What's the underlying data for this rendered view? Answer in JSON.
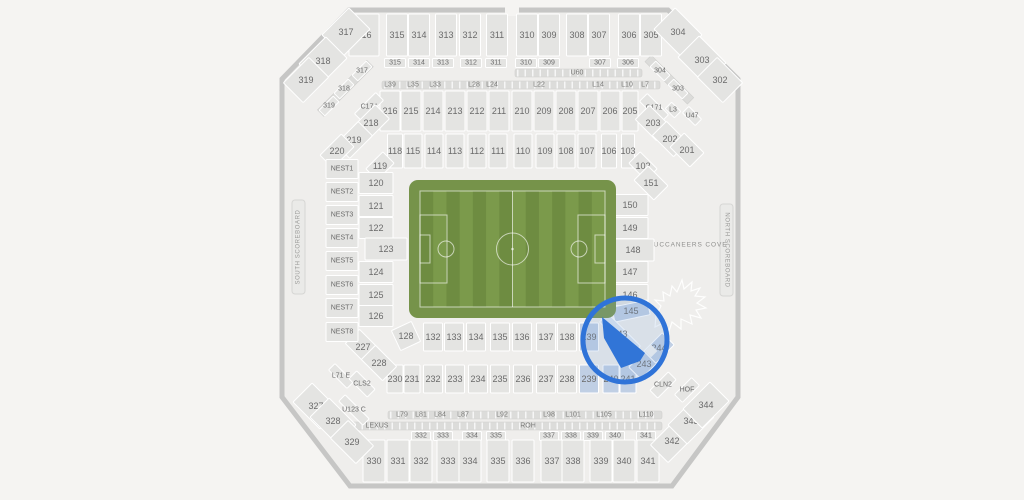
{
  "map": {
    "venue_note": "stadium seating chart with soccer field",
    "colors": {
      "page_bg": "#f5f4f2",
      "wall": "#c6c6c5",
      "concourse": "#efeeec",
      "section_fill": "#e4e4e2",
      "label_color": "#6a6a6a",
      "highlight_fill": "#c0cfe4",
      "highlight_strip_fill": "#dbe5f2",
      "selected_fill": "#1d68d6",
      "circle_stroke": "#2f73d8",
      "field_apron": "#76934a",
      "field_dark": "#6e8c41",
      "field_light": "#7b9a4b"
    },
    "labels_static": {
      "south_scoreboard": "SOUTH SCOREBOARD",
      "north_scoreboard": "NORTH SCOREBOARD",
      "cove": "BUCCANEERS COVE"
    },
    "section_groups": [
      {
        "name": "upper-300-top",
        "y": 35,
        "h": 42,
        "w": 21,
        "items": [
          {
            "t": "316",
            "x": 364,
            "w": 30
          },
          {
            "t": "315",
            "x": 397
          },
          {
            "t": "314",
            "x": 419
          },
          {
            "t": "313",
            "x": 446
          },
          {
            "t": "312",
            "x": 470
          },
          {
            "t": "311",
            "x": 497
          },
          {
            "t": "310",
            "x": 527
          },
          {
            "t": "309",
            "x": 549
          },
          {
            "t": "308",
            "x": 577
          },
          {
            "t": "307",
            "x": 599
          },
          {
            "t": "306",
            "x": 629
          },
          {
            "t": "305",
            "x": 651
          }
        ]
      },
      {
        "name": "upper-300-corners",
        "w": 38,
        "h": 30,
        "items": [
          {
            "t": "317",
            "x": 346,
            "y": 32,
            "r": -45
          },
          {
            "t": "318",
            "x": 323,
            "y": 61,
            "r": -45
          },
          {
            "t": "319",
            "x": 306,
            "y": 80,
            "r": -45,
            "w": 36,
            "h": 28
          },
          {
            "t": "304",
            "x": 678,
            "y": 32,
            "r": 45
          },
          {
            "t": "303",
            "x": 702,
            "y": 60,
            "r": 45
          },
          {
            "t": "302",
            "x": 720,
            "y": 80,
            "r": 45,
            "w": 36,
            "h": 28
          }
        ]
      },
      {
        "name": "suite-row-300",
        "y": 63,
        "h": 9,
        "w": 21,
        "f": 7,
        "items": [
          {
            "t": "315",
            "x": 395
          },
          {
            "t": "314",
            "x": 419
          },
          {
            "t": "313",
            "x": 443
          },
          {
            "t": "312",
            "x": 471
          },
          {
            "t": "311",
            "x": 496
          },
          {
            "t": "310",
            "x": 526
          },
          {
            "t": "309",
            "x": 549
          },
          {
            "t": "307",
            "x": 600
          },
          {
            "t": "306",
            "x": 628
          }
        ]
      },
      {
        "name": "suite-diag",
        "w": 20,
        "h": 8,
        "f": 7,
        "items": [
          {
            "t": "317",
            "x": 362,
            "y": 71,
            "r": -45
          },
          {
            "t": "318",
            "x": 344,
            "y": 89,
            "r": -45
          },
          {
            "t": "319",
            "x": 329,
            "y": 106,
            "r": -45
          },
          {
            "t": "304",
            "x": 660,
            "y": 71,
            "r": 45
          },
          {
            "t": "303",
            "x": 678,
            "y": 89,
            "r": 45
          }
        ]
      },
      {
        "name": "upper-200-top",
        "y": 111,
        "h": 40,
        "w": 20,
        "items": [
          {
            "t": "216",
            "x": 390
          },
          {
            "t": "215",
            "x": 411
          },
          {
            "t": "214",
            "x": 433
          },
          {
            "t": "213",
            "x": 455
          },
          {
            "t": "212",
            "x": 477
          },
          {
            "t": "211",
            "x": 499
          },
          {
            "t": "210",
            "x": 522
          },
          {
            "t": "209",
            "x": 544
          },
          {
            "t": "208",
            "x": 566
          },
          {
            "t": "207",
            "x": 588
          },
          {
            "t": "206",
            "x": 610
          },
          {
            "t": "205",
            "x": 630,
            "w": 16
          }
        ]
      },
      {
        "name": "corner-200-left",
        "items": [
          {
            "t": "C174",
            "x": 369,
            "y": 107,
            "r": -45,
            "w": 30,
            "h": 11,
            "f": 7
          },
          {
            "t": "218",
            "x": 371,
            "y": 123,
            "r": -45,
            "w": 32,
            "h": 20
          },
          {
            "t": "219",
            "x": 354,
            "y": 140,
            "r": -45,
            "w": 32,
            "h": 20
          },
          {
            "t": "220",
            "x": 337,
            "y": 151,
            "r": -45,
            "w": 30,
            "h": 18
          }
        ]
      },
      {
        "name": "corner-200-right",
        "items": [
          {
            "t": "C171",
            "x": 654,
            "y": 108,
            "r": 45,
            "w": 30,
            "h": 11,
            "f": 7
          },
          {
            "t": "L3",
            "x": 673,
            "y": 110,
            "r": 45,
            "w": 13,
            "h": 9,
            "f": 7
          },
          {
            "t": "U47",
            "x": 692,
            "y": 116,
            "r": 45,
            "w": 18,
            "h": 9,
            "f": 7
          },
          {
            "t": "203",
            "x": 653,
            "y": 123,
            "r": 45,
            "w": 30,
            "h": 20
          },
          {
            "t": "202",
            "x": 670,
            "y": 139,
            "r": 45,
            "w": 30,
            "h": 20
          },
          {
            "t": "201",
            "x": 687,
            "y": 150,
            "r": 45,
            "w": 28,
            "h": 20
          }
        ]
      },
      {
        "name": "upper-100-top",
        "y": 151,
        "h": 34,
        "w": 18,
        "items": [
          {
            "t": "118",
            "x": 395,
            "w": 15
          },
          {
            "t": "115",
            "x": 413
          },
          {
            "t": "114",
            "x": 434
          },
          {
            "t": "113",
            "x": 455
          },
          {
            "t": "112",
            "x": 477
          },
          {
            "t": "111",
            "x": 498
          },
          {
            "t": "110",
            "x": 523
          },
          {
            "t": "109",
            "x": 545
          },
          {
            "t": "108",
            "x": 566
          },
          {
            "t": "107",
            "x": 587
          },
          {
            "t": "106",
            "x": 609,
            "w": 15
          },
          {
            "t": "103",
            "x": 628,
            "w": 13
          }
        ]
      },
      {
        "name": "corner-100",
        "items": [
          {
            "t": "119",
            "x": 380,
            "y": 166,
            "r": -45,
            "w": 24,
            "h": 16
          },
          {
            "t": "102",
            "x": 643,
            "y": 166,
            "r": 45,
            "w": 24,
            "h": 16
          },
          {
            "t": "151",
            "x": 651,
            "y": 183,
            "r": 45,
            "w": 28,
            "h": 20
          }
        ]
      },
      {
        "name": "left-col-100",
        "x": 376,
        "w": 34,
        "h": 21,
        "items": [
          {
            "t": "120",
            "y": 183
          },
          {
            "t": "121",
            "y": 206
          },
          {
            "t": "122",
            "y": 228
          },
          {
            "t": "123",
            "x": 386,
            "y": 249,
            "w": 42,
            "h": 22
          },
          {
            "t": "124",
            "y": 272
          },
          {
            "t": "125",
            "y": 295
          },
          {
            "t": "126",
            "y": 316
          }
        ]
      },
      {
        "name": "right-col-100",
        "x": 630,
        "w": 36,
        "h": 21,
        "items": [
          {
            "t": "150",
            "y": 205
          },
          {
            "t": "149",
            "y": 228
          },
          {
            "t": "148",
            "x": 633,
            "y": 250,
            "w": 42,
            "h": 22
          },
          {
            "t": "147",
            "y": 272
          },
          {
            "t": "146",
            "y": 295
          },
          {
            "t": "145",
            "x": 631,
            "y": 311,
            "w": 36,
            "h": 15,
            "r": -12,
            "c": "hl"
          }
        ]
      },
      {
        "name": "lower-100-bottom",
        "y": 337,
        "h": 28,
        "w": 19,
        "items": [
          {
            "t": "128",
            "x": 406,
            "y": 336,
            "r": -25,
            "w": 22,
            "h": 22
          },
          {
            "t": "132",
            "x": 433
          },
          {
            "t": "133",
            "x": 454
          },
          {
            "t": "134",
            "x": 476
          },
          {
            "t": "135",
            "x": 500
          },
          {
            "t": "136",
            "x": 522
          },
          {
            "t": "137",
            "x": 546
          },
          {
            "t": "138",
            "x": 567
          },
          {
            "t": "139",
            "x": 589,
            "c": "hl"
          },
          {
            "t": "143",
            "x": 620,
            "y": 334,
            "r": 45,
            "w": 46,
            "h": 12,
            "c": "hl2"
          }
        ]
      },
      {
        "name": "lower-200-bottom",
        "y": 379,
        "h": 28,
        "w": 19,
        "items": [
          {
            "t": "230",
            "x": 395,
            "w": 16
          },
          {
            "t": "231",
            "x": 412,
            "w": 16
          },
          {
            "t": "232",
            "x": 433
          },
          {
            "t": "233",
            "x": 455
          },
          {
            "t": "234",
            "x": 478
          },
          {
            "t": "235",
            "x": 500
          },
          {
            "t": "236",
            "x": 523
          },
          {
            "t": "237",
            "x": 546
          },
          {
            "t": "238",
            "x": 567
          },
          {
            "t": "239",
            "x": 589,
            "c": "hl"
          },
          {
            "t": "240",
            "x": 611,
            "w": 16,
            "c": "hl"
          },
          {
            "t": "241",
            "x": 628,
            "w": 16,
            "c": "hl"
          }
        ]
      },
      {
        "name": "corner-200-bottom",
        "items": [
          {
            "t": "227",
            "x": 363,
            "y": 347,
            "r": 45,
            "w": 30,
            "h": 20
          },
          {
            "t": "228",
            "x": 379,
            "y": 363,
            "r": 45,
            "w": 30,
            "h": 20
          },
          {
            "t": "243",
            "x": 644,
            "y": 364,
            "r": -45,
            "w": 26,
            "h": 17,
            "c": "hl"
          },
          {
            "t": "244",
            "x": 659,
            "y": 348,
            "r": -45,
            "w": 26,
            "h": 17,
            "c": "hl"
          }
        ]
      },
      {
        "name": "club-diag",
        "items": [
          {
            "t": "CLN2",
            "x": 663,
            "y": 385,
            "r": -45,
            "w": 26,
            "h": 11,
            "f": 7
          },
          {
            "t": "HOF",
            "x": 687,
            "y": 390,
            "r": -45,
            "w": 24,
            "h": 11,
            "f": 7
          },
          {
            "t": "L71 E",
            "x": 341,
            "y": 376,
            "r": 45,
            "w": 26,
            "h": 9,
            "f": 7
          },
          {
            "t": "CLS2",
            "x": 362,
            "y": 384,
            "r": 45,
            "w": 26,
            "h": 11,
            "f": 7
          },
          {
            "t": "U123 C",
            "x": 354,
            "y": 410,
            "r": 45,
            "w": 34,
            "h": 9,
            "f": 7
          }
        ]
      },
      {
        "name": "mid-tiny-row",
        "y": 436,
        "h": 9,
        "w": 19,
        "f": 7,
        "items": [
          {
            "t": "332",
            "x": 421
          },
          {
            "t": "333",
            "x": 443
          },
          {
            "t": "334",
            "x": 472
          },
          {
            "t": "335",
            "x": 496
          },
          {
            "t": "337",
            "x": 549
          },
          {
            "t": "338",
            "x": 571
          },
          {
            "t": "339",
            "x": 593
          },
          {
            "t": "340",
            "x": 615
          },
          {
            "t": "341",
            "x": 646
          }
        ]
      },
      {
        "name": "lower-300-bottom",
        "y": 461,
        "h": 42,
        "w": 22,
        "items": [
          {
            "t": "330",
            "x": 374
          },
          {
            "t": "331",
            "x": 398
          },
          {
            "t": "332",
            "x": 421
          },
          {
            "t": "333",
            "x": 448
          },
          {
            "t": "334",
            "x": 470
          },
          {
            "t": "335",
            "x": 498
          },
          {
            "t": "336",
            "x": 523
          },
          {
            "t": "337",
            "x": 552
          },
          {
            "t": "338",
            "x": 573
          },
          {
            "t": "339",
            "x": 601
          },
          {
            "t": "340",
            "x": 624
          },
          {
            "t": "341",
            "x": 648
          }
        ]
      },
      {
        "name": "corner-300-bottom",
        "items": [
          {
            "t": "327",
            "x": 316,
            "y": 406,
            "r": 45,
            "w": 38,
            "h": 27
          },
          {
            "t": "328",
            "x": 333,
            "y": 421,
            "r": 45,
            "w": 38,
            "h": 27
          },
          {
            "t": "329",
            "x": 352,
            "y": 442,
            "r": 45,
            "w": 36,
            "h": 25
          },
          {
            "t": "342",
            "x": 672,
            "y": 441,
            "r": -45,
            "w": 36,
            "h": 25
          },
          {
            "t": "343",
            "x": 691,
            "y": 421,
            "r": -45,
            "w": 38,
            "h": 27
          },
          {
            "t": "344",
            "x": 706,
            "y": 405,
            "r": -45,
            "w": 38,
            "h": 27
          }
        ]
      },
      {
        "name": "nest-col",
        "x": 342,
        "w": 32,
        "h": 19,
        "f": 7,
        "items": [
          {
            "t": "NEST1",
            "y": 169
          },
          {
            "t": "NEST2",
            "y": 192
          },
          {
            "t": "NEST3",
            "y": 215
          },
          {
            "t": "NEST4",
            "y": 238
          },
          {
            "t": "NEST5",
            "y": 261
          },
          {
            "t": "NEST6",
            "y": 285
          },
          {
            "t": "NEST7",
            "y": 308
          },
          {
            "t": "NEST8",
            "y": 332
          }
        ]
      }
    ],
    "strip_labels": [
      {
        "t": "U60",
        "x": 577,
        "y": 73
      },
      {
        "t": "L39",
        "x": 390,
        "y": 85
      },
      {
        "t": "L35",
        "x": 413,
        "y": 85
      },
      {
        "t": "L33",
        "x": 435,
        "y": 85
      },
      {
        "t": "L28",
        "x": 474,
        "y": 85
      },
      {
        "t": "L24",
        "x": 492,
        "y": 85
      },
      {
        "t": "L22",
        "x": 539,
        "y": 85
      },
      {
        "t": "L14",
        "x": 598,
        "y": 85
      },
      {
        "t": "L10",
        "x": 627,
        "y": 85
      },
      {
        "t": "L7",
        "x": 645,
        "y": 85
      },
      {
        "t": "L79",
        "x": 402,
        "y": 415
      },
      {
        "t": "L81",
        "x": 421,
        "y": 415
      },
      {
        "t": "L84",
        "x": 440,
        "y": 415
      },
      {
        "t": "L87",
        "x": 463,
        "y": 415
      },
      {
        "t": "L92",
        "x": 502,
        "y": 415
      },
      {
        "t": "L98",
        "x": 549,
        "y": 415
      },
      {
        "t": "L101",
        "x": 573,
        "y": 415
      },
      {
        "t": "L105",
        "x": 604,
        "y": 415
      },
      {
        "t": "L110",
        "x": 646,
        "y": 415
      },
      {
        "t": "LEXUS",
        "x": 377,
        "y": 426
      },
      {
        "t": "ROH",
        "x": 528,
        "y": 426
      }
    ],
    "highlight": {
      "circle": {
        "cx": 625,
        "cy": 340,
        "r": 42
      },
      "selected_wedge_points": "602,317 645,353 640,361 621,368 604,338",
      "diamond": {
        "x": 651,
        "y": 351
      }
    }
  }
}
